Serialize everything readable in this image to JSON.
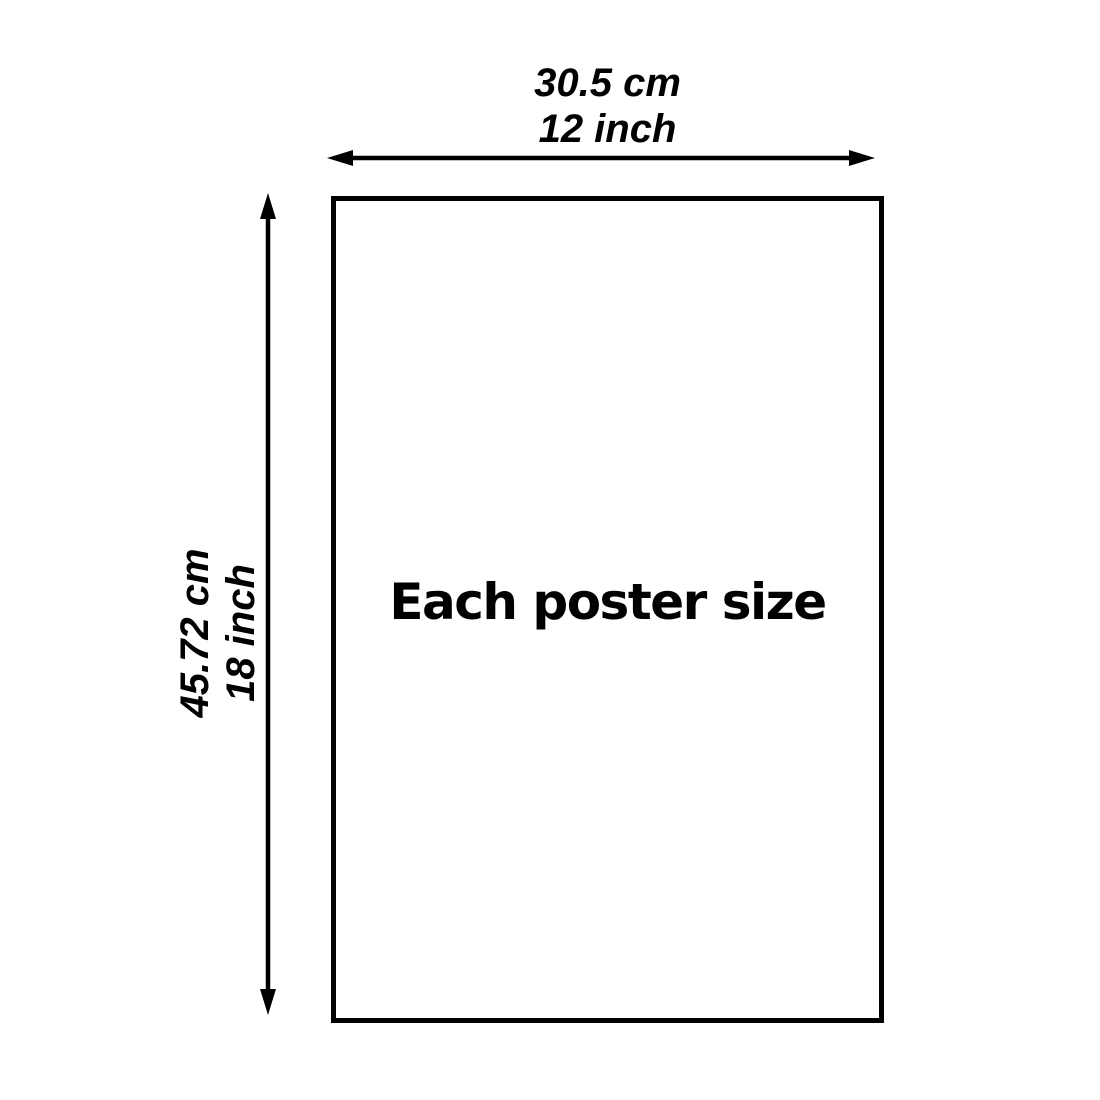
{
  "diagram": {
    "caption": "Each poster size",
    "width_dimension": {
      "cm": "30.5 cm",
      "inch": "12 inch"
    },
    "height_dimension": {
      "cm": "45.72 cm",
      "inch": "18 inch"
    },
    "colors": {
      "line": "#000000",
      "background": "#ffffff",
      "text": "#000000"
    }
  }
}
